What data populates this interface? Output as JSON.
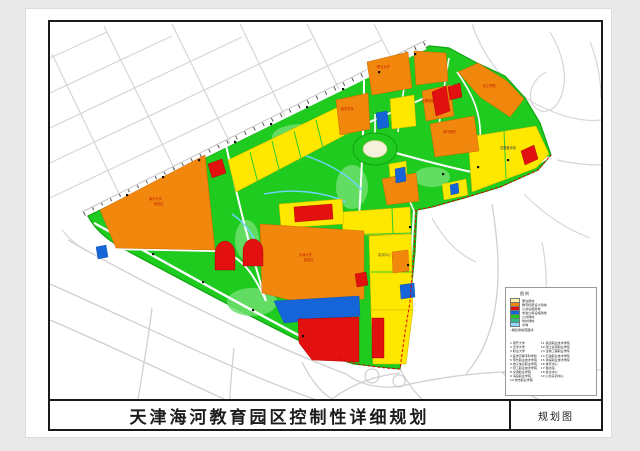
{
  "title_block": {
    "title": "天津海河教育园区控制性详细规划",
    "sheet_label": "规划图"
  },
  "legend": {
    "title": "图例",
    "items": [
      {
        "label": "居住用地",
        "color": "#FFF1A6"
      },
      {
        "label": "教育科研设计用地",
        "color": "#F2870D"
      },
      {
        "label": "公共设施用地",
        "color": "#E31010"
      },
      {
        "label": "市政公用设施用地",
        "color": "#1565D8"
      },
      {
        "label": "公共绿地",
        "color": "#1FCB1F"
      },
      {
        "label": "防护绿地",
        "color": "#2EBD8C"
      },
      {
        "label": "水域",
        "color": "#8FD8FF"
      }
    ],
    "boundary_note": "规划用地范围线",
    "facilities_left": [
      "1 南开大学",
      "2 天津大学",
      "3 职业大学",
      "4 医学高等专科学校",
      "5 现代职业技术学院",
      "6 电子信息职业学院",
      "7 轻工职业技术学院",
      "8 交通职业学院",
      "9 海运职业学院",
      "10 城市职业学院"
    ],
    "facilities_right": [
      "11 铁道职业技术学院",
      "12 国土资源职业学院",
      "13 生物工程职业学院",
      "14 石油职业技术学院",
      "15 渤海职业技术学院",
      "16 体育中心",
      "17 图书馆",
      "18 会议中心",
      "19 公共实训中心"
    ]
  },
  "map": {
    "colors": {
      "green_base": "#1FCB1F",
      "orange_parcel": "#F2870D",
      "yellow_parcel": "#FFE800",
      "red_parcel": "#E31010",
      "blue_parcel": "#1565D8",
      "water_line": "#6FD4FF",
      "boundary_dash": "#E00000",
      "outside_road": "#D6D6D6"
    },
    "labels": [
      {
        "t": "南开大学",
        "x": 149,
        "y": 198,
        "c": "#C22000"
      },
      {
        "t": "新校区",
        "x": 154,
        "y": 203,
        "c": "#C22000"
      },
      {
        "t": "天津大学",
        "x": 299,
        "y": 254,
        "c": "#C22000"
      },
      {
        "t": "新校区",
        "x": 304,
        "y": 259,
        "c": "#C22000"
      },
      {
        "t": "职业大学",
        "x": 377,
        "y": 66,
        "c": "#C22000"
      },
      {
        "t": "医学高专",
        "x": 341,
        "y": 108,
        "c": "#C22000"
      },
      {
        "t": "交通职院",
        "x": 421,
        "y": 100,
        "c": "#C22000"
      },
      {
        "t": "现代职院",
        "x": 443,
        "y": 131,
        "c": "#C22000"
      },
      {
        "t": "轻工职院",
        "x": 483,
        "y": 85,
        "c": "#C22000"
      },
      {
        "t": "发展备用地",
        "x": 500,
        "y": 147,
        "c": "#444444"
      },
      {
        "t": "实训中心",
        "x": 378,
        "y": 254,
        "c": "#444444"
      }
    ]
  }
}
